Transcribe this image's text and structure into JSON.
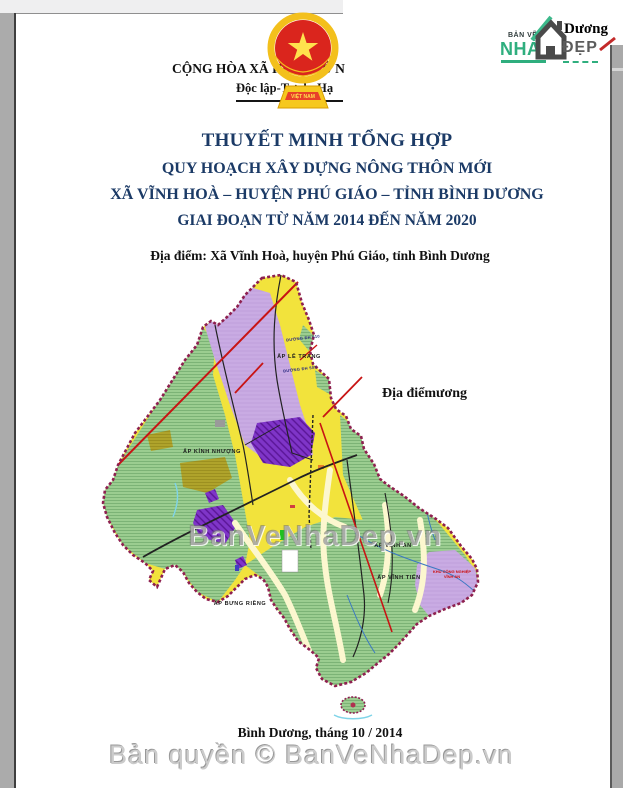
{
  "header": {
    "motto_line1": "CỘNG HÒA XÃ HỘI CHỦ N",
    "motto_line2": "Độc lập-Tự do-Hạ",
    "emblem_banner": "VIỆT NAM"
  },
  "logo": {
    "ban_ve": "BẢN VẼ",
    "nha": "NHÀ",
    "dep": "ĐẸP",
    "duong": "Dương",
    "accent_color": "#2fae7e"
  },
  "title_block": {
    "line1": "THUYẾT MINH TỔNG HỢP",
    "line2": "QUY HOẠCH XÂY DỰNG NÔNG THÔN MỚI",
    "line3": "XÃ VĨNH HOÀ – HUYỆN PHÚ GIÁO – TỈNH BÌNH DƯƠNG",
    "line4": "GIAI ĐOẠN TỪ NĂM 2014 ĐẾN NĂM 2020",
    "color": "#1b3a66"
  },
  "location_line": "Địa điểm: Xã Vĩnh Hoà, huyện Phú Giáo, tỉnh Bình Dương",
  "map": {
    "side_note": "Địa điểmương",
    "watermark": "BanVeNhaDep.vn",
    "labels": [
      {
        "text": "ẤP LỄ TRANG"
      },
      {
        "text": "ẤP KỈNH NHƯỢNG"
      },
      {
        "text": "ẤP VĨNH AN"
      },
      {
        "text": "ẤP VĨNH TIẾN"
      },
      {
        "text": "ẤP BƯNG RIỀNG"
      },
      {
        "text": "KHU CÔNG NGHIỆP VĨNH AN"
      },
      {
        "text": "ĐƯỜNG ĐH 510"
      },
      {
        "text": "ĐƯỜNG ĐH 509"
      }
    ],
    "colors": {
      "boundary": "#8e2050",
      "farmland_yellow": "#f2e33c",
      "forest_green": "#9bcd90",
      "planning_lavender": "#c9abe3",
      "industry_violet": "#7f35c8",
      "orchard_olive": "#afa32b"
    }
  },
  "footer": {
    "date_line": "Bình Dương, tháng 10 / 2014",
    "copyright": "Bản quyền © BanVeNhaDep.vn"
  }
}
